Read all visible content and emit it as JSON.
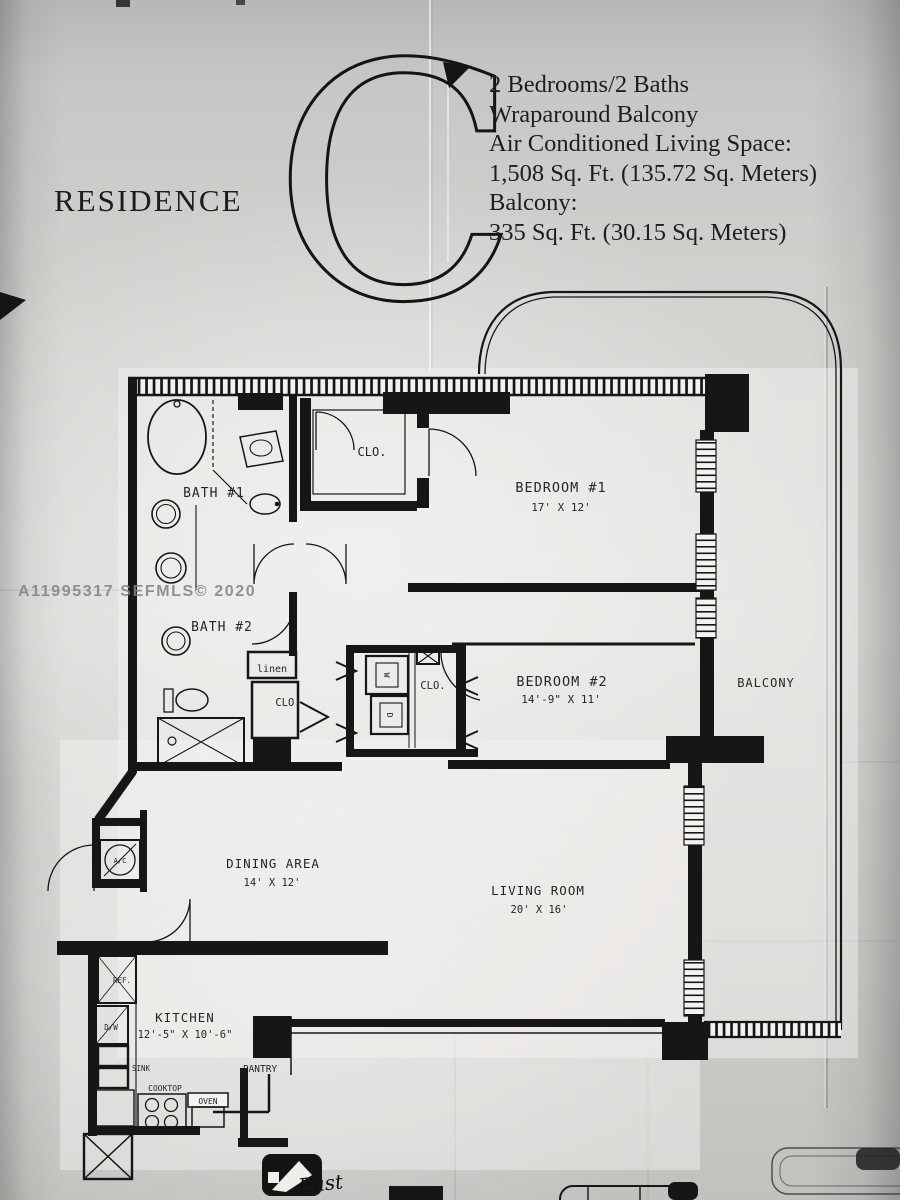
{
  "colors": {
    "ink": "#1a1a1a",
    "paper": "#cbcac7"
  },
  "title": {
    "residence_label": "RESIDENCE",
    "letter": "C"
  },
  "summary": {
    "lines": [
      "2 Bedrooms/2 Baths",
      "Wraparound Balcony",
      "Air Conditioned Living Space:",
      "1,508 Sq. Ft. (135.72 Sq. Meters)",
      "Balcony:",
      "335 Sq. Ft. (30.15 Sq. Meters)"
    ]
  },
  "watermark": {
    "text": "A11995317 SEFMLS© 2020"
  },
  "rooms": {
    "bath1": {
      "name": "BATH #1"
    },
    "bath2": {
      "name": "BATH #2"
    },
    "closet_top": {
      "name": "CLO."
    },
    "closet_hall": {
      "name": "CLO."
    },
    "closet_utility": {
      "name": "CLO."
    },
    "linen": {
      "name": "linen"
    },
    "bedroom1": {
      "name": "BEDROOM #1",
      "dims": "17' X 12'"
    },
    "bedroom2": {
      "name": "BEDROOM #2",
      "dims": "14'-9\" X 11'"
    },
    "balcony": {
      "name": "BALCONY"
    },
    "dining": {
      "name": "DINING AREA",
      "dims": "14' X 12'"
    },
    "living": {
      "name": "LIVING ROOM",
      "dims": "20' X 16'"
    },
    "kitchen": {
      "name": "KITCHEN",
      "dims": "12'-5\" X 10'-6\""
    },
    "pantry": {
      "name": "PANTRY"
    }
  },
  "appliances": {
    "refrigerator": "REF.",
    "dishwasher": "D/W",
    "sink": "SINK",
    "cooktop": "COOKTOP",
    "oven": "OVEN",
    "ac_unit": "A/C",
    "washer": "W",
    "dryer": "D"
  },
  "compass": {
    "east_label": "East"
  }
}
